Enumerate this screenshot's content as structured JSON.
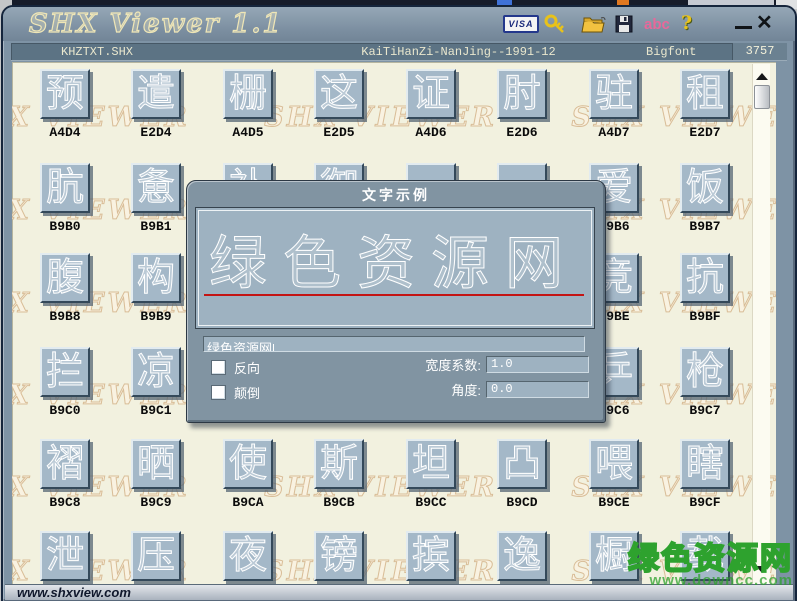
{
  "window": {
    "title": "SHX Viewer 1.1"
  },
  "titlebar": {
    "visa_label": "VISA",
    "abc_label": "abc",
    "help_label": "?",
    "close_glyph": "✕"
  },
  "infobar": {
    "filename": "KHZTXT.SHX",
    "description": "KaiTiHanZi-NanJing--1991-12",
    "font_type": "Bigfont",
    "count": "3757"
  },
  "watermark": {
    "pattern": "SHX VIEWER",
    "corner_text": "绿色资源网",
    "corner_url": "www.downcc.com"
  },
  "grid": {
    "rows": [
      {
        "cells": [
          {
            "glyph": "预",
            "code": "A4D4"
          },
          {
            "glyph": "遣",
            "code": "E2D4"
          },
          {
            "glyph": "栅",
            "code": "A4D5"
          },
          {
            "glyph": "这",
            "code": "E2D5"
          },
          {
            "glyph": "证",
            "code": "A4D6"
          },
          {
            "glyph": "肘",
            "code": "E2D6"
          },
          {
            "glyph": "驻",
            "code": "A4D7"
          },
          {
            "glyph": "租",
            "code": "E2D7"
          }
        ]
      },
      {
        "cells": [
          {
            "glyph": "肮",
            "code": "B9B0"
          },
          {
            "glyph": "惫",
            "code": "B9B1"
          },
          {
            "glyph": "补",
            "code": ""
          },
          {
            "glyph": "御",
            "code": ""
          },
          {
            "glyph": "",
            "code": ""
          },
          {
            "glyph": "",
            "code": ""
          },
          {
            "glyph": "爱",
            "code": "B9B6"
          },
          {
            "glyph": "饭",
            "code": "B9B7"
          }
        ]
      },
      {
        "cells": [
          {
            "glyph": "腹",
            "code": "B9B8"
          },
          {
            "glyph": "构",
            "code": "B9B9"
          },
          {
            "glyph": "",
            "code": ""
          },
          {
            "glyph": "",
            "code": ""
          },
          {
            "glyph": "",
            "code": ""
          },
          {
            "glyph": "",
            "code": ""
          },
          {
            "glyph": "竞",
            "code": "B9BE"
          },
          {
            "glyph": "抗",
            "code": "B9BF"
          }
        ]
      },
      {
        "cells": [
          {
            "glyph": "拦",
            "code": "B9C0"
          },
          {
            "glyph": "凉",
            "code": "B9C1"
          },
          {
            "glyph": "",
            "code": ""
          },
          {
            "glyph": "",
            "code": ""
          },
          {
            "glyph": "",
            "code": ""
          },
          {
            "glyph": "",
            "code": ""
          },
          {
            "glyph": "乒",
            "code": "B9C6"
          },
          {
            "glyph": "枪",
            "code": "B9C7"
          }
        ]
      },
      {
        "cells": [
          {
            "glyph": "褶",
            "code": "B9C8"
          },
          {
            "glyph": "晒",
            "code": "B9C9"
          },
          {
            "glyph": "使",
            "code": "B9CA"
          },
          {
            "glyph": "斯",
            "code": "B9CB"
          },
          {
            "glyph": "坦",
            "code": "B9CC"
          },
          {
            "glyph": "凸",
            "code": "B9CD"
          },
          {
            "glyph": "喂",
            "code": "B9CE"
          },
          {
            "glyph": "瞎",
            "code": "B9CF"
          }
        ]
      },
      {
        "cells": [
          {
            "glyph": "泄",
            "code": ""
          },
          {
            "glyph": "压",
            "code": ""
          },
          {
            "glyph": "夜",
            "code": ""
          },
          {
            "glyph": "镑",
            "code": ""
          },
          {
            "glyph": "摈",
            "code": ""
          },
          {
            "glyph": "逸",
            "code": ""
          },
          {
            "glyph": "橱",
            "code": ""
          },
          {
            "glyph": "载",
            "code": ""
          }
        ]
      }
    ]
  },
  "dialog": {
    "title": "文字示例",
    "preview_text": "绿色资源网",
    "input_value": "绿色资源网",
    "option_reverse": "反向",
    "option_flip": "颠倒",
    "width_label": "宽度系数:",
    "width_value": "1.0",
    "angle_label": "角度:",
    "angle_value": "0.0"
  },
  "statusbar": {
    "text": "www.shxview.com"
  },
  "colors": {
    "frame": "#7e93a5",
    "content_bg": "#f2f1df",
    "button_face": "#a4b8c8",
    "infobar_bg": "#5c7384",
    "red_underline": "#c41414",
    "green_watermark": "#2ea22e",
    "title_cream": "#efe6b6"
  }
}
